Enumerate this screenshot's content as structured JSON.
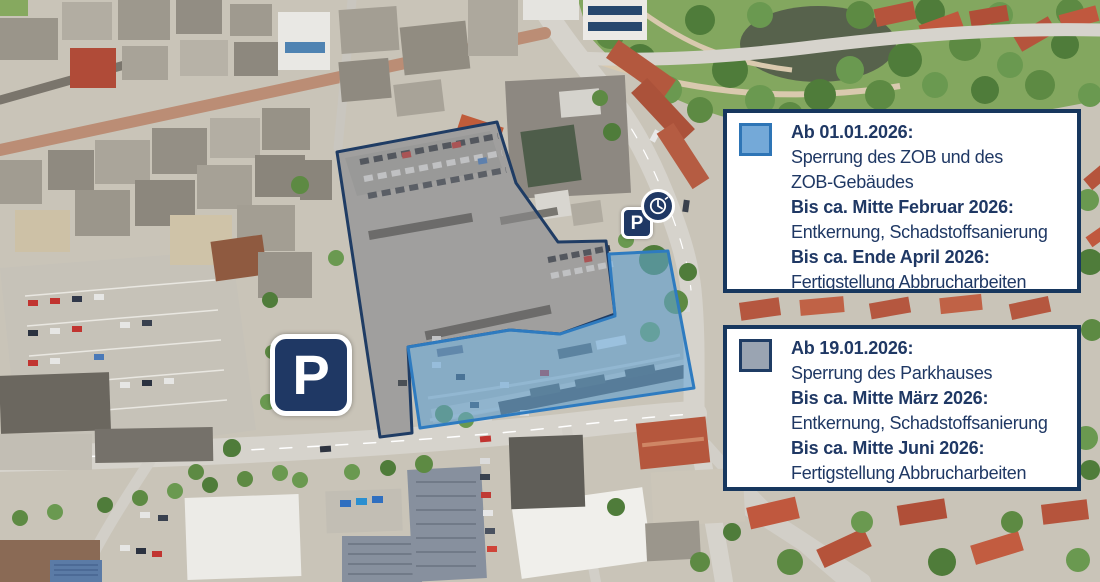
{
  "overlays": {
    "zob_area": {
      "fill": "rgba(96,165,220,0.55)",
      "stroke": "#2e7bc0"
    },
    "parkhaus_area": {
      "fill": "rgba(150,153,158,0.35)",
      "stroke": "#1f3c64"
    }
  },
  "parking_signs": {
    "large": {
      "label": "P"
    },
    "small": {
      "label": "P"
    }
  },
  "icons": {
    "clock_badge": "clock-icon"
  },
  "info_boxes": [
    {
      "id": "zob",
      "swatch": {
        "fill": "#74a9d8",
        "stroke": "#2e75b6"
      },
      "lines": [
        {
          "text": "Ab 01.01.2026:",
          "bold": true
        },
        {
          "text": "Sperrung des ZOB und des",
          "bold": false
        },
        {
          "text": "ZOB-Gebäudes",
          "bold": false
        },
        {
          "text": "Bis ca. Mitte Februar 2026:",
          "bold": true
        },
        {
          "text": "Entkernung, Schadstoffsanierung",
          "bold": false
        },
        {
          "text": "Bis ca. Ende April 2026:",
          "bold": true
        },
        {
          "text": "Fertigstellung Abbrucharbeiten",
          "bold": false
        }
      ]
    },
    {
      "id": "parkhaus",
      "swatch": {
        "fill": "#9aa4b2",
        "stroke": "#1f3c64"
      },
      "lines": [
        {
          "text": "Ab 19.01.2026:",
          "bold": true
        },
        {
          "text": "Sperrung des Parkhauses",
          "bold": false
        },
        {
          "text": "Bis ca. Mitte März 2026:",
          "bold": true
        },
        {
          "text": "Entkernung, Schadstoffsanierung",
          "bold": false
        },
        {
          "text": "Bis ca. Mitte Juni 2026:",
          "bold": true
        },
        {
          "text": "Fertigstellung Abbrucharbeiten",
          "bold": false
        }
      ]
    }
  ],
  "colors": {
    "navy_text": "#1f3864",
    "box_border": "#17375e",
    "sign_background": "#1f3864",
    "sign_border": "#ffffff"
  }
}
